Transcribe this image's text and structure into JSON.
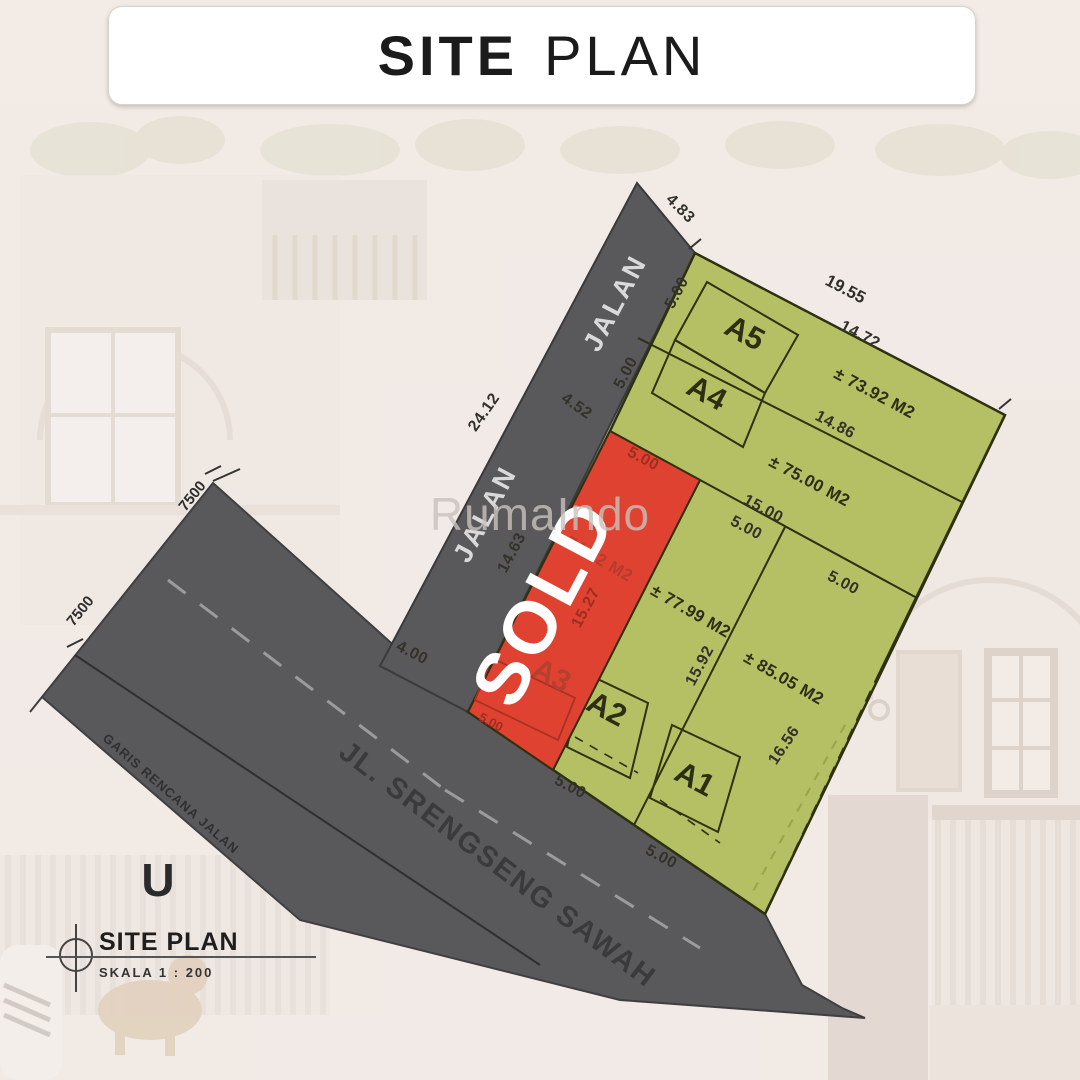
{
  "title": {
    "word1": "SITE",
    "word2": "PLAN"
  },
  "watermark": "RumaIndo",
  "legend": {
    "north": "U",
    "title": "SITE PLAN",
    "scale": "SKALA 1 : 200"
  },
  "roads": {
    "jalan": {
      "label_upper": "JALAN",
      "label_lower": "JALAN"
    },
    "srengseng": {
      "name": "JL. SRENGSENG SAWAH",
      "plan_line": "GARIS RENCANA JALAN",
      "width_upper": "7500",
      "width_left": "7500"
    }
  },
  "plots": {
    "a5": {
      "label": "A5",
      "area": "± 73.92 M2",
      "top": "14.72",
      "frontage": "5.00"
    },
    "a4": {
      "label": "A4",
      "area": "± 75.00 M2",
      "boundary": "14.86",
      "frontage": "5.00"
    },
    "a3": {
      "label": "A3",
      "status": "SOLD",
      "area": "± 74.72 M2",
      "top": "5.00",
      "right": "15.27",
      "bottom": "5.00"
    },
    "a2": {
      "label": "A2",
      "area": "± 77.99 M2",
      "top": "5.00",
      "bottom": "5.00"
    },
    "a1": {
      "label": "A1",
      "area": "± 85.05 M2",
      "top": "5.00",
      "bottom": "5.00"
    }
  },
  "dims": {
    "site_top": "19.55",
    "road_cap": "4.83",
    "strip_line": "15.00",
    "a2_a1_divider": "15.92",
    "site_right": "16.56",
    "jalan_left": "24.12",
    "jalan_width": "4.52",
    "jalan_right": "14.63",
    "jalan_bottom": "4.00"
  },
  "colors": {
    "background": "#f2ebe6",
    "road": "#59595b",
    "plot_green": "#b5c064",
    "plot_red": "#e04232",
    "line": "#2e3110",
    "sold_text": "#ffffff"
  }
}
